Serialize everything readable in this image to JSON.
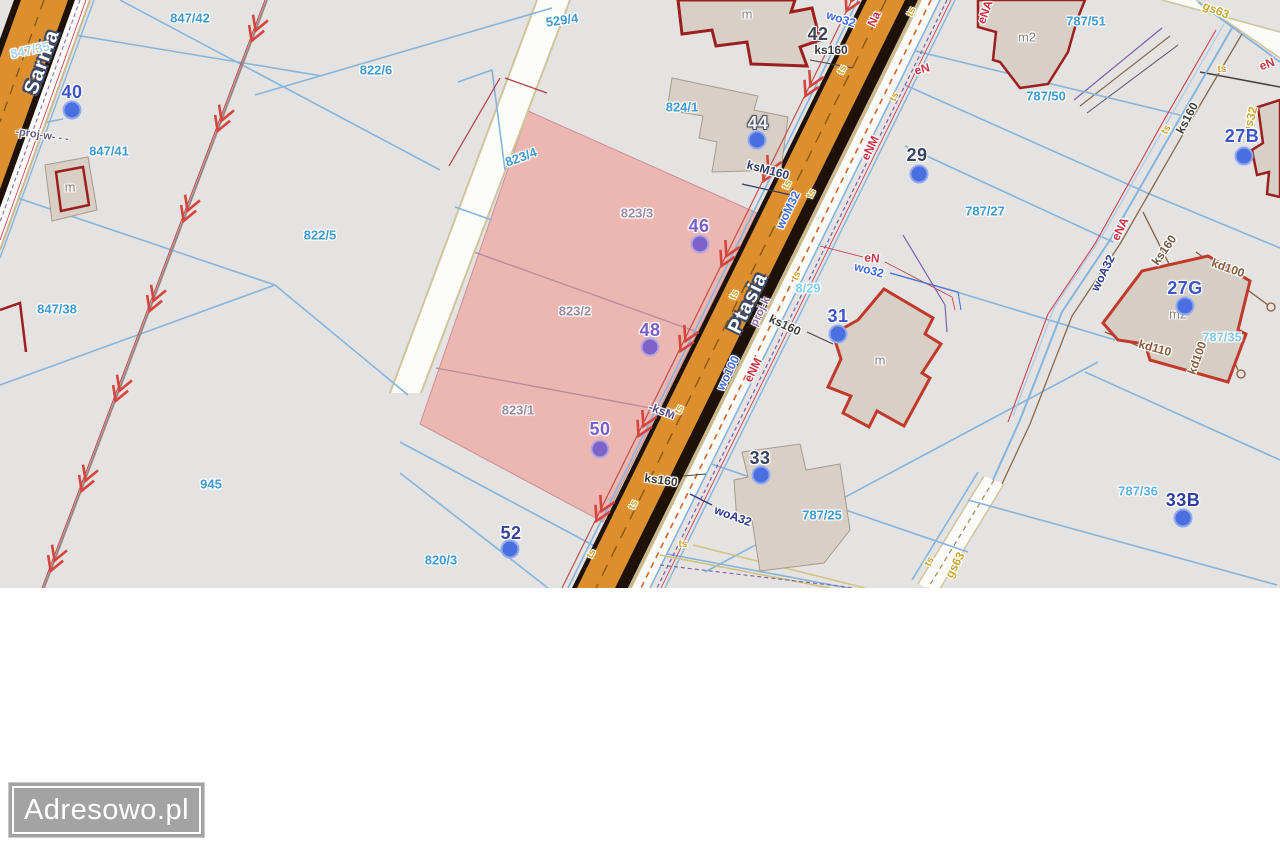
{
  "watermark": {
    "text": "Adresowo.pl"
  },
  "map": {
    "accent_colors": {
      "parcel_line": "#85b4dd",
      "road_fill": "#dd8f2e",
      "highlight_fill": "#ecb6b1",
      "utility_red": "#cc3344",
      "utility_blue": "#3f6adf",
      "utility_yellow": "#cfa02a",
      "building_outline": "#9c1f1f"
    },
    "street_labels": [
      {
        "name": "Sarnia",
        "x": 42,
        "y": 62,
        "rot": -70
      },
      {
        "name": "Ptasia",
        "x": 748,
        "y": 303,
        "rot": -64
      }
    ],
    "parcel_labels": [
      {
        "label": "847/42",
        "x": 190,
        "y": 18
      },
      {
        "label": "847/41",
        "x": 109,
        "y": 151
      },
      {
        "label": "847/38",
        "x": 57,
        "y": 309
      },
      {
        "label": "847/35",
        "x": 30,
        "y": 50,
        "rot": -12,
        "color": "#a8d4e8"
      },
      {
        "label": "945",
        "x": 211,
        "y": 484
      },
      {
        "label": "820/3",
        "x": 441,
        "y": 560
      },
      {
        "label": "822/6",
        "x": 376,
        "y": 70
      },
      {
        "label": "822/5",
        "x": 320,
        "y": 235
      },
      {
        "label": "529/4",
        "x": 562,
        "y": 20,
        "rot": -8
      },
      {
        "label": "823/4",
        "x": 521,
        "y": 157,
        "rot": -20
      },
      {
        "label": "824/1",
        "x": 682,
        "y": 107
      },
      {
        "label": "823/3",
        "x": 637,
        "y": 213,
        "color": "#9a8aa2"
      },
      {
        "label": "823/2",
        "x": 575,
        "y": 311,
        "color": "#9a8aa2"
      },
      {
        "label": "823/1",
        "x": 518,
        "y": 410,
        "color": "#9a8aa2"
      },
      {
        "label": "787/51",
        "x": 1086,
        "y": 21
      },
      {
        "label": "787/50",
        "x": 1046,
        "y": 96
      },
      {
        "label": "787/27",
        "x": 985,
        "y": 211
      },
      {
        "label": "8/29",
        "x": 808,
        "y": 288,
        "color": "#7fd0f0"
      },
      {
        "label": "787/25",
        "x": 822,
        "y": 515
      },
      {
        "label": "787/35",
        "x": 1222,
        "y": 337,
        "color": "#86c8ea"
      },
      {
        "label": "787/36",
        "x": 1138,
        "y": 491,
        "color": "#5fb0e6"
      }
    ],
    "address_markers": [
      {
        "number": "40",
        "x": 72,
        "y": 92,
        "dot": {
          "x": 72,
          "y": 110
        }
      },
      {
        "number": "42",
        "x": 818,
        "y": 34,
        "color": "#3f4654"
      },
      {
        "number": "44",
        "x": 758,
        "y": 123,
        "color": "#f2f2f4",
        "halo": "#4a5264",
        "dot": {
          "x": 757,
          "y": 140
        }
      },
      {
        "number": "46",
        "x": 699,
        "y": 226,
        "color": "#7a5ec8",
        "dot": {
          "x": 700,
          "y": 244
        },
        "dot_color": "#7b63c8"
      },
      {
        "number": "48",
        "x": 650,
        "y": 330,
        "color": "#7a5ec8",
        "dot": {
          "x": 650,
          "y": 347
        },
        "dot_color": "#7b63c8"
      },
      {
        "number": "50",
        "x": 600,
        "y": 429,
        "color": "#7a5ec8",
        "dot": {
          "x": 600,
          "y": 449
        },
        "dot_color": "#7b63c8"
      },
      {
        "number": "52",
        "x": 511,
        "y": 533,
        "color": "#36459c",
        "dot": {
          "x": 510,
          "y": 549
        }
      },
      {
        "number": "29",
        "x": 917,
        "y": 155,
        "color": "#39435f",
        "dot": {
          "x": 919,
          "y": 174
        }
      },
      {
        "number": "31",
        "x": 838,
        "y": 316,
        "dot": {
          "x": 838,
          "y": 334
        }
      },
      {
        "number": "33",
        "x": 760,
        "y": 458,
        "color": "#39435f",
        "dot": {
          "x": 761,
          "y": 475
        }
      },
      {
        "number": "33B",
        "x": 1183,
        "y": 500,
        "color": "#2e3f9f",
        "dot": {
          "x": 1183,
          "y": 518
        }
      },
      {
        "number": "27B",
        "x": 1242,
        "y": 136,
        "dot": {
          "x": 1244,
          "y": 156
        }
      },
      {
        "number": "27G",
        "x": 1185,
        "y": 288,
        "dot": {
          "x": 1185,
          "y": 306
        }
      }
    ],
    "building_labels": [
      {
        "label": "m",
        "x": 747,
        "y": 14
      },
      {
        "label": "m2",
        "x": 1027,
        "y": 37
      },
      {
        "label": "m",
        "x": 70,
        "y": 187
      },
      {
        "label": "m",
        "x": 880,
        "y": 360
      },
      {
        "label": "m2",
        "x": 1178,
        "y": 314
      }
    ],
    "utility_labels": [
      {
        "label": "wo32",
        "x": 841,
        "y": 19,
        "rot": 18,
        "color": "#3f6adf"
      },
      {
        "label": "wo32",
        "x": 869,
        "y": 270,
        "rot": 15,
        "color": "#3f6adf"
      },
      {
        "label": "woM32",
        "x": 788,
        "y": 210,
        "rot": -64,
        "color": "#3f6adf"
      },
      {
        "label": "wo100",
        "x": 728,
        "y": 373,
        "rot": -64,
        "color": "#3f6adf"
      },
      {
        "label": "woA32",
        "x": 733,
        "y": 516,
        "rot": 20,
        "color": "#2d3a8c"
      },
      {
        "label": "woA32",
        "x": 1103,
        "y": 273,
        "rot": -64,
        "color": "#2d3a8c"
      },
      {
        "label": "ks160",
        "x": 831,
        "y": 50,
        "rot": 0,
        "color": "#3c3c3c"
      },
      {
        "label": "ks160",
        "x": 785,
        "y": 325,
        "rot": 25,
        "color": "#3c3c3c"
      },
      {
        "label": "ks160",
        "x": 661,
        "y": 480,
        "rot": 8,
        "color": "#3c3c3c"
      },
      {
        "label": "ks160",
        "x": 1187,
        "y": 118,
        "rot": -62,
        "color": "#3c3c3c"
      },
      {
        "label": "ks160",
        "x": 1164,
        "y": 250,
        "rot": -55,
        "color": "#6e5a45"
      },
      {
        "label": "ksM160",
        "x": 768,
        "y": 170,
        "rot": 15,
        "color": "#2f3a66"
      },
      {
        "label": "-ksM",
        "x": 662,
        "y": 411,
        "rot": 20,
        "color": "#5a4a8a"
      },
      {
        "label": "kd100",
        "x": 1228,
        "y": 268,
        "rot": 20,
        "color": "#8a5c3c"
      },
      {
        "label": "kd100",
        "x": 1197,
        "y": 358,
        "rot": -70,
        "color": "#8a5c3c"
      },
      {
        "label": "kd110",
        "x": 1155,
        "y": 348,
        "rot": 15,
        "color": "#8a5c3c"
      },
      {
        "label": "eNM",
        "x": 870,
        "y": 148,
        "rot": -64,
        "color": "#cc3344"
      },
      {
        "label": "eNM",
        "x": 753,
        "y": 370,
        "rot": -64,
        "color": "#cc3344"
      },
      {
        "label": "eN",
        "x": 922,
        "y": 69,
        "rot": -15,
        "color": "#cc3344"
      },
      {
        "label": "eN",
        "x": 872,
        "y": 258,
        "rot": 5,
        "color": "#cc3344"
      },
      {
        "label": "eN",
        "x": 1267,
        "y": 64,
        "rot": -20,
        "color": "#cc3344"
      },
      {
        "label": "eNA",
        "x": 985,
        "y": 12,
        "rot": -70,
        "color": "#cc3344"
      },
      {
        "label": "eNA",
        "x": 1120,
        "y": 229,
        "rot": -64,
        "color": "#cc3344"
      },
      {
        "label": "Na",
        "x": 874,
        "y": 19,
        "rot": -64,
        "color": "#cc3344"
      },
      {
        "label": "gs63",
        "x": 1216,
        "y": 10,
        "rot": 22,
        "color": "#c8a832"
      },
      {
        "label": "gs63",
        "x": 955,
        "y": 565,
        "rot": -62,
        "color": "#c8a832"
      },
      {
        "label": "gs32",
        "x": 1250,
        "y": 120,
        "rot": -75,
        "color": "#c8a832"
      },
      {
        "label": "-proj-w- - -",
        "x": 42,
        "y": 136,
        "rot": 8,
        "color": "#5f5f7d",
        "size": 11
      },
      {
        "label": "proj-k",
        "x": 761,
        "y": 312,
        "rot": -64,
        "color": "#8a6aa0",
        "size": 11
      }
    ],
    "infra_markers": [
      {
        "label": "ts",
        "x": 843,
        "y": 70,
        "rot": -64
      },
      {
        "label": "ts",
        "x": 788,
        "y": 185,
        "rot": -64
      },
      {
        "label": "ts",
        "x": 735,
        "y": 295,
        "rot": -64
      },
      {
        "label": "ts",
        "x": 680,
        "y": 410,
        "rot": -64
      },
      {
        "label": "ts",
        "x": 634,
        "y": 505,
        "rot": -64
      },
      {
        "label": "ts",
        "x": 812,
        "y": 194,
        "rot": -64
      },
      {
        "label": "ts",
        "x": 797,
        "y": 276,
        "rot": -64
      },
      {
        "label": "ts",
        "x": 895,
        "y": 97,
        "rot": -64
      },
      {
        "label": "ts",
        "x": 912,
        "y": 12,
        "rot": -64
      },
      {
        "label": "ts",
        "x": 683,
        "y": 545,
        "rot": 0
      },
      {
        "label": "ts",
        "x": 592,
        "y": 554,
        "rot": -64
      },
      {
        "label": "ts",
        "x": 930,
        "y": 562,
        "rot": -62
      },
      {
        "label": "ts",
        "x": 1167,
        "y": 130,
        "rot": -60
      },
      {
        "label": "ts",
        "x": 1222,
        "y": 70,
        "rot": 0
      }
    ]
  }
}
